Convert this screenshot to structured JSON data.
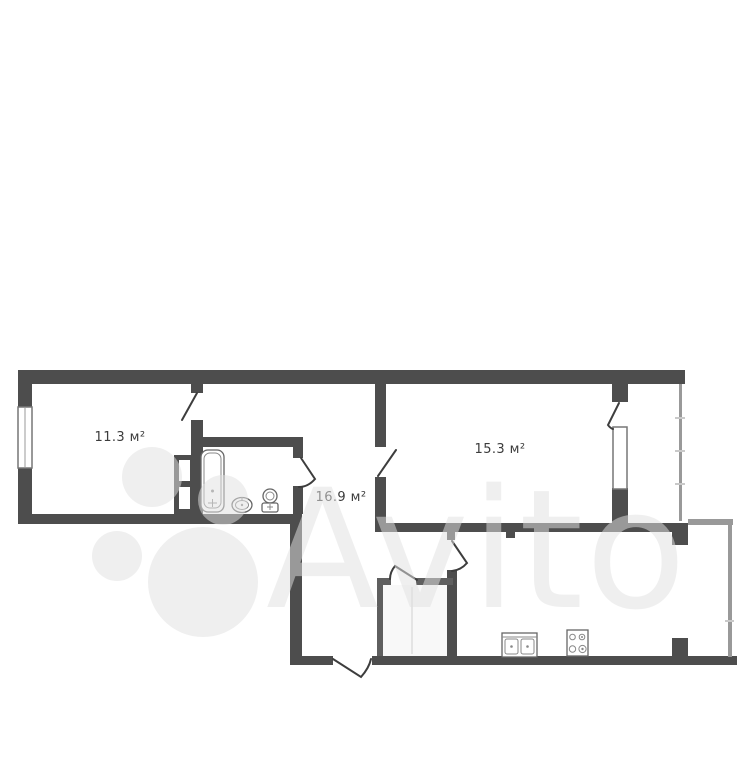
{
  "page": {
    "background": "#ffffff"
  },
  "watermark": {
    "text": "Avito",
    "color": "#e0e0e0"
  },
  "plan": {
    "type": "apartment-floor-plan",
    "unit": "м²",
    "wall_color": "#4d4d4d",
    "rooms": [
      {
        "id": "room-left",
        "area_label": "11.3 м²"
      },
      {
        "id": "room-right",
        "area_label": "15.3 м²"
      },
      {
        "id": "hallway",
        "area_label": "16.9 м²"
      }
    ],
    "fixtures": [
      {
        "id": "bathtub"
      },
      {
        "id": "wash-basin"
      },
      {
        "id": "toilet"
      },
      {
        "id": "kitchen-sink"
      },
      {
        "id": "stove"
      }
    ]
  }
}
